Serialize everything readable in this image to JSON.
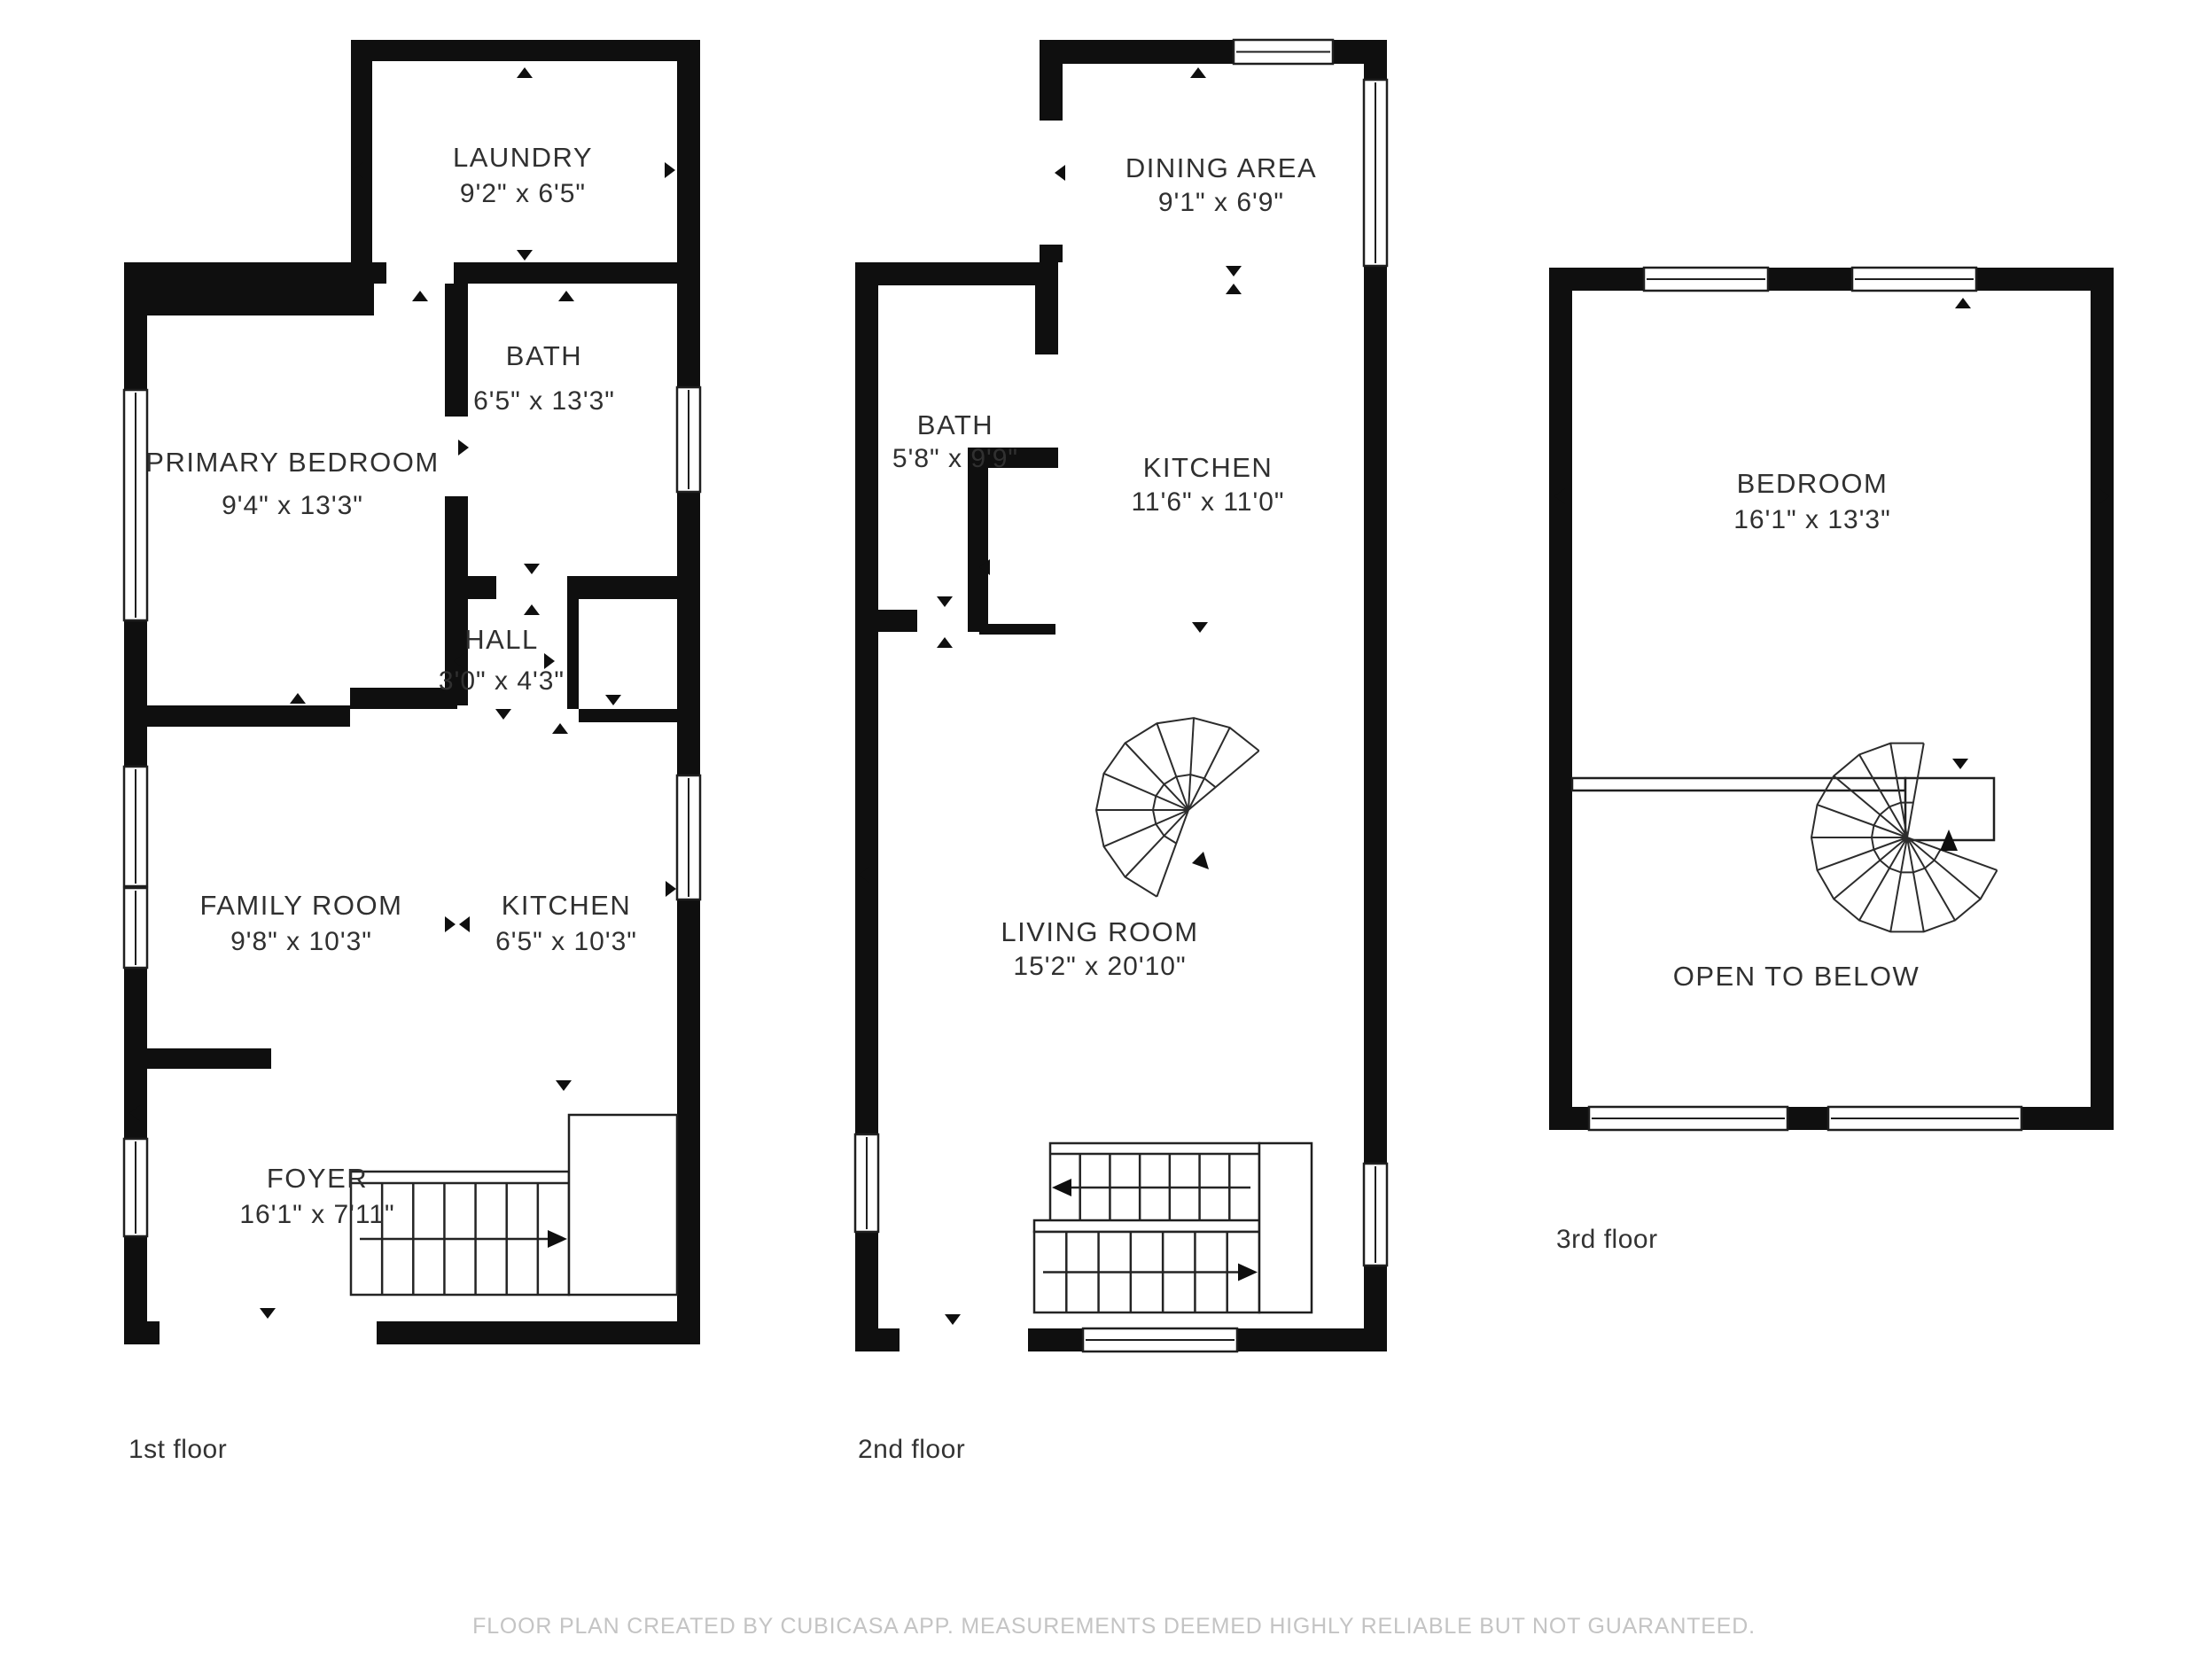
{
  "colors": {
    "background": "#ffffff",
    "wall": "#0f0f0f",
    "line": "#2c2c2c",
    "room_text": "#303030",
    "caption_text": "#333333",
    "disclaimer_text": "#c4c4c4"
  },
  "floors": [
    {
      "label": "1st floor",
      "rooms": [
        {
          "name": "LAUNDRY",
          "dims": "9'2\" x 6'5\""
        },
        {
          "name": "PRIMARY BEDROOM",
          "dims": "9'4\" x 13'3\""
        },
        {
          "name": "BATH",
          "dims": "6'5\" x 13'3\""
        },
        {
          "name": "HALL",
          "dims": "3'0\" x 4'3\""
        },
        {
          "name": "FAMILY ROOM",
          "dims": "9'8\" x 10'3\""
        },
        {
          "name": "KITCHEN",
          "dims": "6'5\" x 10'3\""
        },
        {
          "name": "FOYER",
          "dims": "16'1\" x 7'11\""
        }
      ]
    },
    {
      "label": "2nd floor",
      "rooms": [
        {
          "name": "DINING AREA",
          "dims": "9'1\" x 6'9\""
        },
        {
          "name": "BATH",
          "dims": "5'8\" x 9'9\""
        },
        {
          "name": "KITCHEN",
          "dims": "11'6\" x 11'0\""
        },
        {
          "name": "LIVING ROOM",
          "dims": "15'2\" x 20'10\""
        }
      ]
    },
    {
      "label": "3rd floor",
      "rooms": [
        {
          "name": "BEDROOM",
          "dims": "16'1\" x 13'3\""
        },
        {
          "name": "OPEN TO BELOW",
          "dims": ""
        }
      ]
    }
  ],
  "footer": {
    "disclaimer": "FLOOR PLAN CREATED BY CUBICASA APP. MEASUREMENTS DEEMED HIGHLY RELIABLE BUT NOT GUARANTEED."
  }
}
